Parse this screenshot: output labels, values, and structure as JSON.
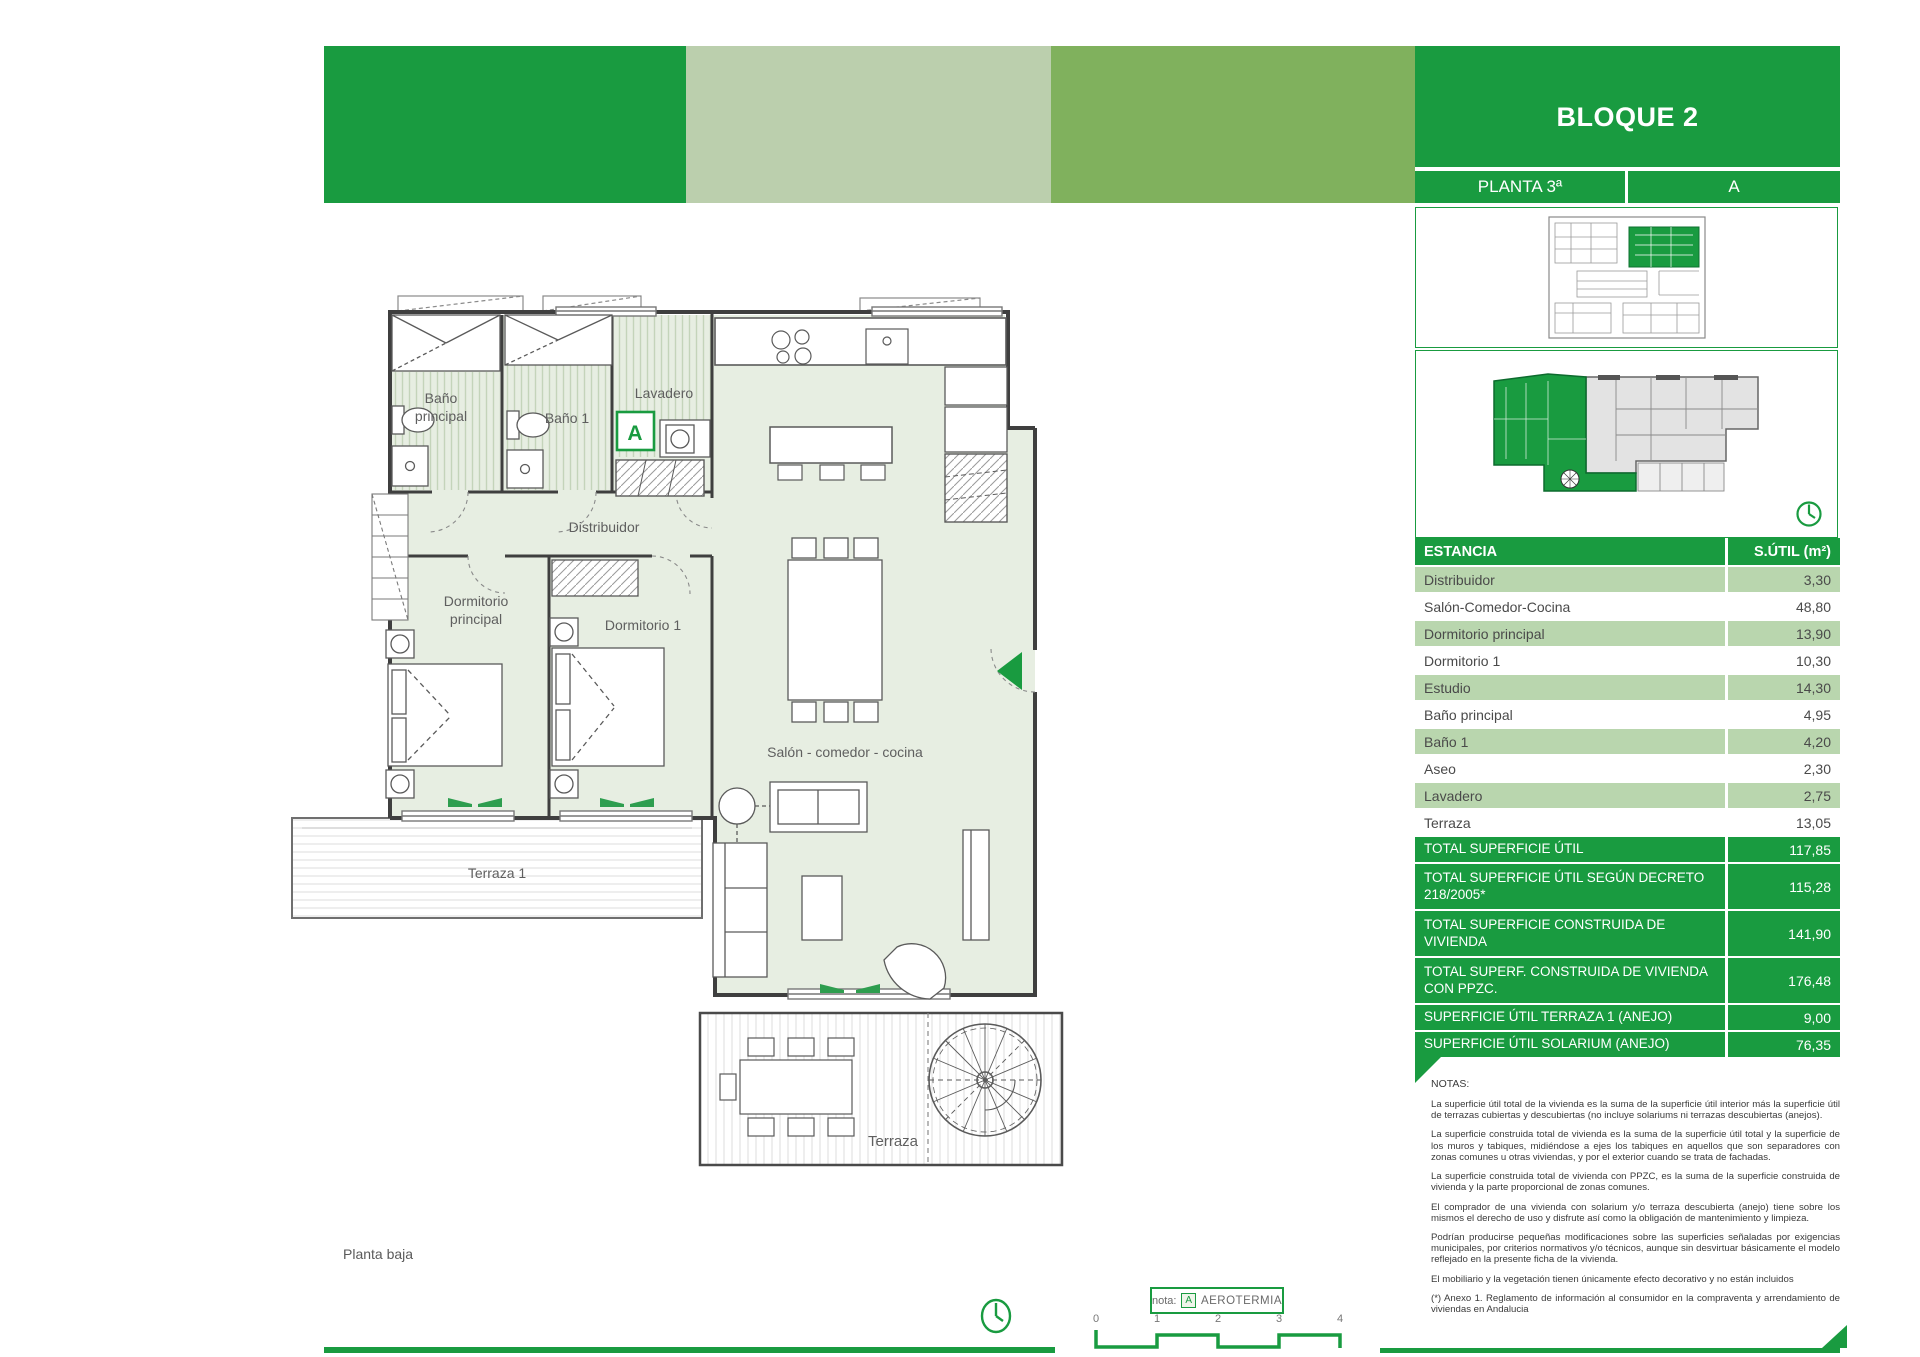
{
  "header": {
    "block_title": "BLOQUE 2",
    "floor_label": "PLANTA 3ª",
    "unit_label": "A"
  },
  "colors": {
    "brand_green": "#199b40",
    "band_pale": "#bbcfad",
    "band_medium": "#80b15d",
    "row_light_green": "#b9d6ae",
    "floor_fill": "#e7eee2"
  },
  "table": {
    "header": {
      "name": "ESTANCIA",
      "value": "S.ÚTIL (m²)"
    },
    "rows": [
      {
        "name": "Distribuidor",
        "value": "3,30"
      },
      {
        "name": "Salón-Comedor-Cocina",
        "value": "48,80"
      },
      {
        "name": "Dormitorio principal",
        "value": "13,90"
      },
      {
        "name": "Dormitorio 1",
        "value": "10,30"
      },
      {
        "name": "Estudio",
        "value": "14,30"
      },
      {
        "name": "Baño principal",
        "value": "4,95"
      },
      {
        "name": "Baño 1",
        "value": "4,20"
      },
      {
        "name": "Aseo",
        "value": "2,30"
      },
      {
        "name": "Lavadero",
        "value": "2,75"
      },
      {
        "name": "Terraza",
        "value": "13,05"
      }
    ],
    "totals": [
      {
        "name": "TOTAL SUPERFICIE ÚTIL",
        "value": "117,85"
      },
      {
        "name": "TOTAL SUPERFICIE ÚTIL SEGÚN DECRETO 218/2005*",
        "value": "115,28"
      },
      {
        "name": "TOTAL SUPERFICIE CONSTRUIDA DE VIVIENDA",
        "value": "141,90"
      },
      {
        "name": "TOTAL SUPERF. CONSTRUIDA DE VIVIENDA CON PPZC.",
        "value": "176,48"
      },
      {
        "name": "SUPERFICIE ÚTIL TERRAZA 1 (ANEJO)",
        "value": "9,00"
      },
      {
        "name": "SUPERFICIE ÚTIL SOLARIUM (ANEJO)",
        "value": "76,35"
      }
    ]
  },
  "notes": {
    "title": "NOTAS:",
    "paragraphs": [
      "La superficie útil total de la vivienda es la suma de la superficie útil interior más la superficie útil de terrazas cubiertas y descubiertas (no incluye solariums ni terrazas descubiertas (anejos).",
      "La superficie construida total de vivienda es la suma de la superficie útil total y la superficie de los muros y tabiques, midiéndose a ejes los tabiques en aquellos que son separadores con zonas comunes u otras viviendas, y por el exterior cuando se trata de fachadas.",
      "La superficie construida total de vivienda con PPZC, es la suma de la superficie construida de vivienda y la parte proporcional de zonas comunes.",
      "El comprador de una vivienda con solarium y/o terraza descubierta (anejo) tiene sobre los mismos el derecho de uso y disfrute así como la obligación de mantenimiento y limpieza.",
      "Podrían producirse pequeñas modificaciones sobre las superficies señaladas por exigencias municipales, por criterios normativos y/o técnicos, aunque sin desvirtuar básicamente el modelo reflejado en la presente ficha de la vivienda.",
      "El mobiliario y la vegetación tienen únicamente efecto decorativo y no están incluidos",
      "(*) Anexo 1. Reglamento de información al consumidor en la compraventa y arrendamiento de viviendas en Andalucia"
    ]
  },
  "plan": {
    "labels": {
      "bano_principal_l1": "Baño",
      "bano_principal_l2": "principal",
      "bano1": "Baño 1",
      "lavadero": "Lavadero",
      "distribuidor": "Distribuidor",
      "dormitorio_principal_l1": "Dormitorio",
      "dormitorio_principal_l2": "principal",
      "dormitorio1": "Dormitorio 1",
      "salon": "Salón - comedor - cocina",
      "terraza1": "Terraza 1",
      "terraza": "Terraza"
    },
    "aerotermia_marker": "A",
    "floor_caption": "Planta baja"
  },
  "legend": {
    "nota_label": "nota:",
    "marker": "A",
    "text": "AEROTERMIA"
  },
  "scalebar": {
    "ticks": [
      "0",
      "1",
      "2",
      "3",
      "4"
    ]
  }
}
